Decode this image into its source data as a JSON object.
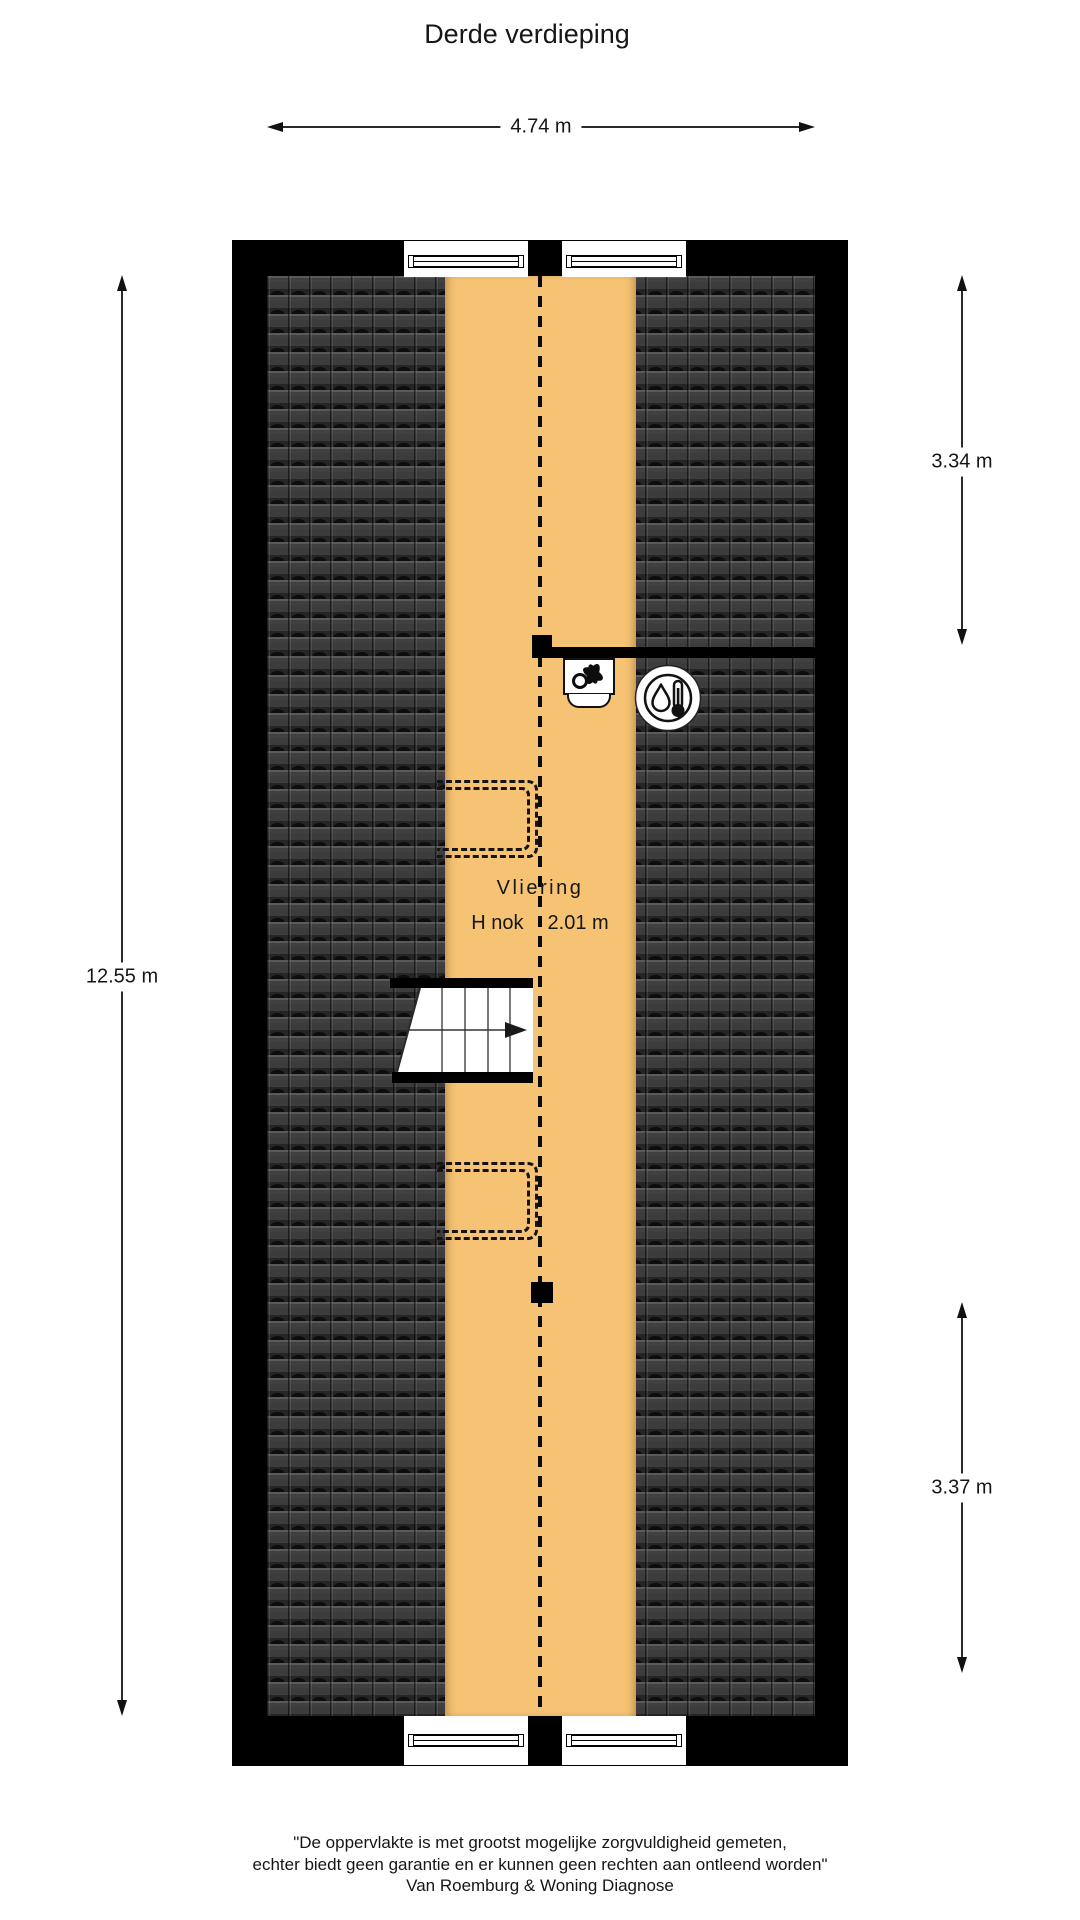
{
  "page": {
    "title": "Derde verdieping"
  },
  "floorplan": {
    "room_label": "Vliering",
    "ridge_height_label": "H nok",
    "ridge_height_value": "2.01 m",
    "colors": {
      "attic_floor": "#F6C375",
      "roof_tiles": "#3C3C3C",
      "walls": "#000000",
      "background": "#FFFFFF"
    },
    "icons": [
      {
        "name": "fan-icon",
        "meaning": "mechanical ventilation unit"
      },
      {
        "name": "thermometer-drop-icon",
        "meaning": "heating installation / boiler"
      }
    ]
  },
  "dimensions": {
    "top_width": "4.74 m",
    "left_height": "12.55 m",
    "right_upper": "3.34 m",
    "right_lower": "3.37 m"
  },
  "footer": {
    "line1": "\"De oppervlakte is met grootst mogelijke zorgvuldigheid gemeten,",
    "line2": "echter biedt geen garantie en er kunnen geen rechten aan ontleend worden\"",
    "line3": "Van Roemburg & Woning Diagnose"
  }
}
